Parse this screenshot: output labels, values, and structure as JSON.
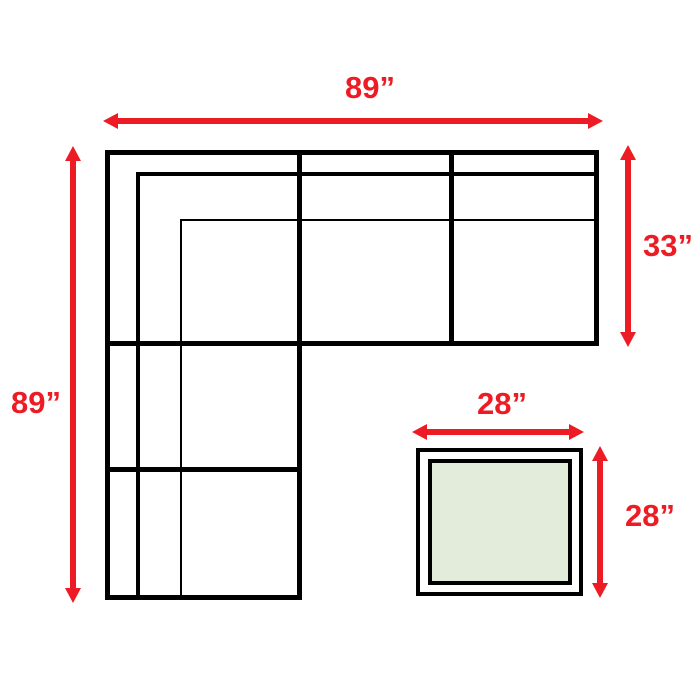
{
  "diagram": {
    "kind": "sectional-sofa-with-ottoman-dimension-diagram",
    "dimensions": {
      "sofa_width_label": "89”",
      "sofa_depth_label": "89”",
      "right_section_depth_label": "33”",
      "ottoman_width_label": "28”",
      "ottoman_depth_label": "28”"
    },
    "colors": {
      "dimension_color": "#ed1c24",
      "outline_color": "#000000",
      "ottoman_fill": "#e3ecda",
      "background": "#ffffff"
    }
  }
}
